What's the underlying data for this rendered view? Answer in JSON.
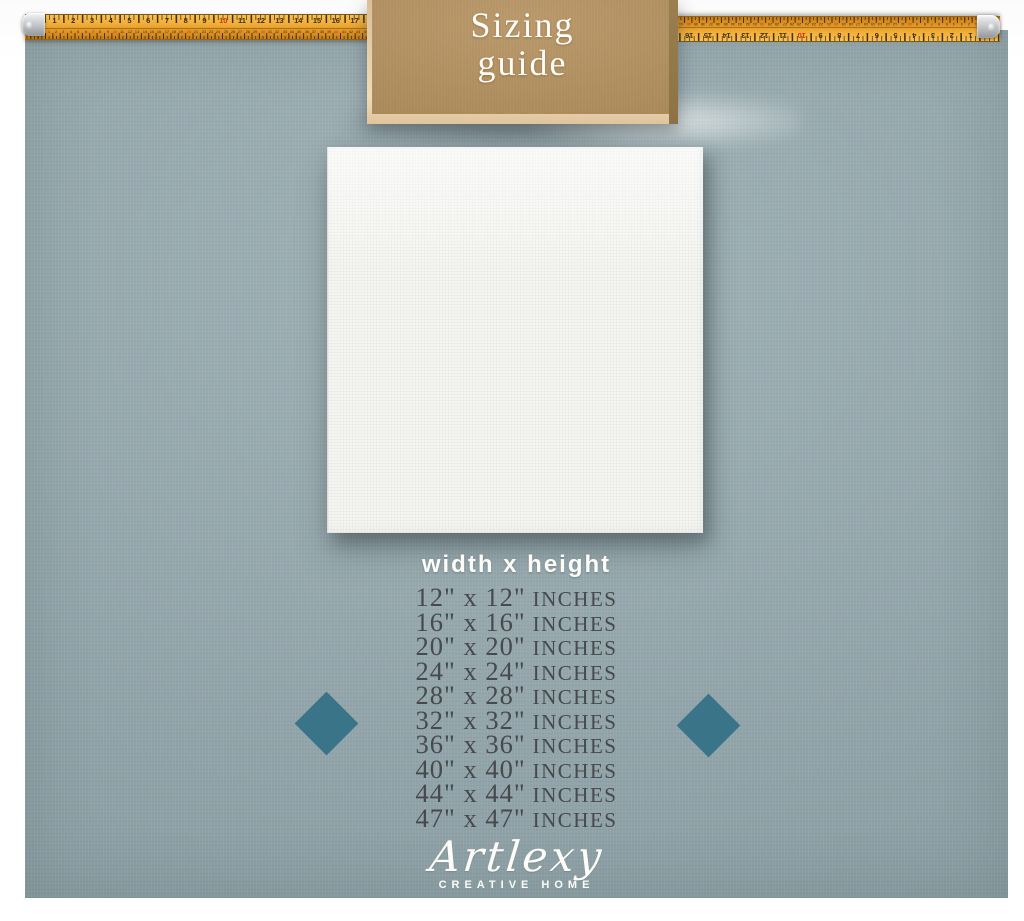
{
  "sign": {
    "line1": "Sizing",
    "line2": "guide"
  },
  "subtitle": "width x height",
  "sizes": {
    "unit": "INCHES",
    "rows": [
      {
        "dims": "12\" x 12\""
      },
      {
        "dims": "16\" x 16\""
      },
      {
        "dims": "20\" x 20\""
      },
      {
        "dims": "24\" x 24\""
      },
      {
        "dims": "28\" x 28\""
      },
      {
        "dims": "32\" x 32\""
      },
      {
        "dims": "36\" x 36\""
      },
      {
        "dims": "40\" x 40\""
      },
      {
        "dims": "44\" x 44\""
      },
      {
        "dims": "47\" x 47\""
      }
    ]
  },
  "ruler": {
    "inch_max": 17,
    "cm_max": 44,
    "red_interval": 10,
    "inch_spacing_px": 18.75,
    "cm_spacing_px": 7.375
  },
  "logo": {
    "name": "Artlexy",
    "tagline": "CREATIVE HOME"
  },
  "colors": {
    "background": "#95a9ae",
    "sign_panel": "#b3905e",
    "sign_frame": "#e9d5b2",
    "diamond": "#3a7488",
    "tape": "#efa934",
    "size_text": "#46494d",
    "light_text": "#fdfcf8"
  }
}
